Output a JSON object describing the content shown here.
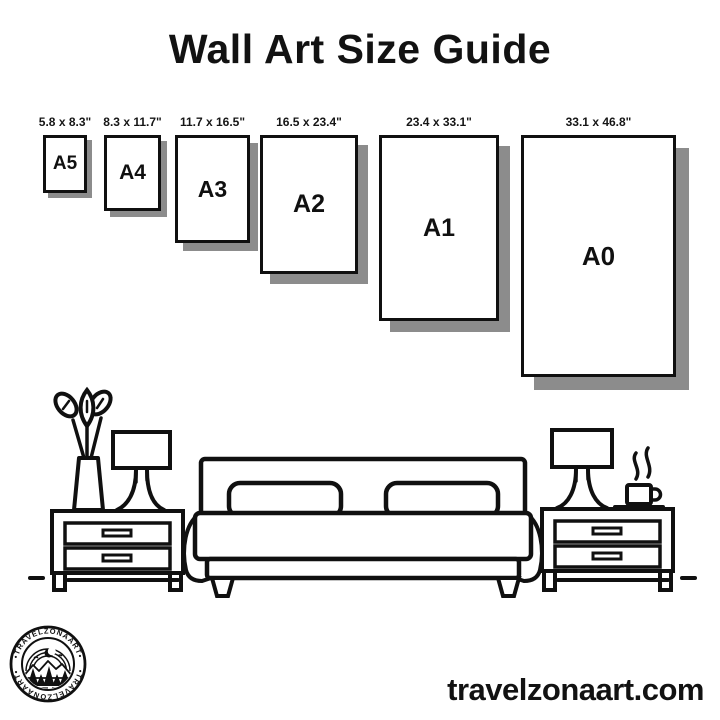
{
  "title": "Wall Art Size Guide",
  "size_guide": {
    "frames": [
      {
        "label": "A5",
        "dimensions": "5.8 x 8.3\""
      },
      {
        "label": "A4",
        "dimensions": "8.3 x 11.7\""
      },
      {
        "label": "A3",
        "dimensions": "11.7 x 16.5\""
      },
      {
        "label": "A2",
        "dimensions": "16.5 x 23.4\""
      },
      {
        "label": "A1",
        "dimensions": "23.4 x 33.1\""
      },
      {
        "label": "A0",
        "dimensions": "33.1 x 46.8\""
      }
    ]
  },
  "illustration": {
    "icons": [
      "plant-vase-icon",
      "table-lamp-icon",
      "nightstand-icon",
      "bed-icon",
      "pillow-icon",
      "coffee-mug-icon",
      "steam-icon",
      "floor-line"
    ]
  },
  "branding": {
    "logo_text_top": "•TRAVELZONAART•",
    "logo_text_bottom": "•TRAVELZONAART•",
    "website": "travelzonaart.com"
  },
  "colors": {
    "ink": "#101010",
    "shadow": "#8c8c8c",
    "background": "#ffffff"
  }
}
